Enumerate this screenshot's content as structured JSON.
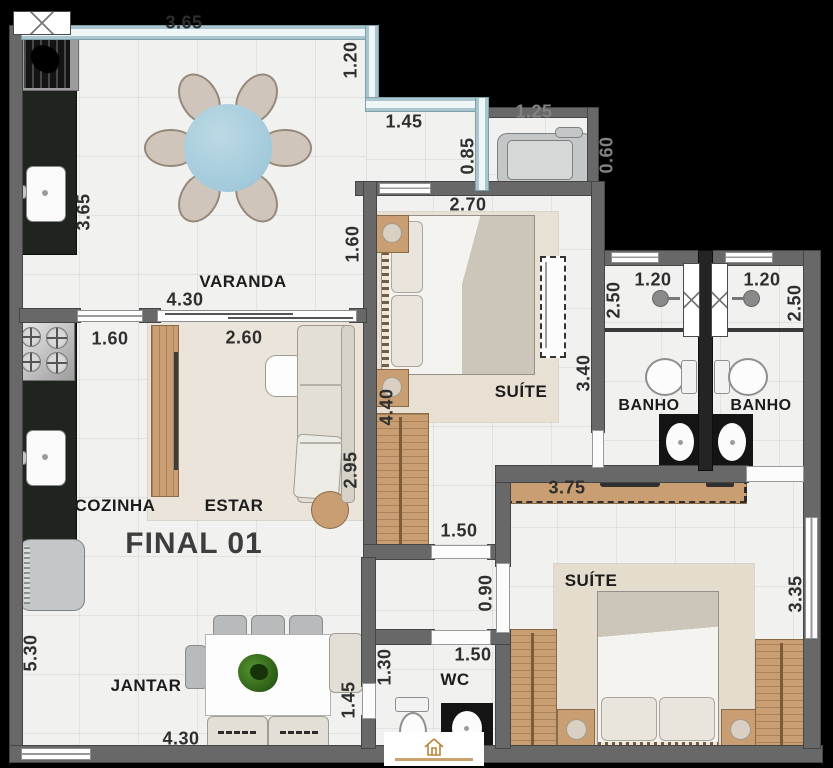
{
  "title": {
    "unit": "FINAL 01"
  },
  "rooms": {
    "varanda": "VARANDA",
    "cozinha": "COZINHA",
    "estar": "ESTAR",
    "jantar": "JANTAR",
    "suite1": "SUÍTE",
    "suite2": "SUÍTE",
    "banho1": "BANHO",
    "banho2": "BANHO",
    "wc": "WC"
  },
  "dims": {
    "varanda_top": "3.65",
    "varanda_left": "3.65",
    "varanda_right": "1.20",
    "step_w": "1.45",
    "step_h": "0.85",
    "ac_w": "1.25",
    "ac_h": "0.60",
    "suite1_w": "2.70",
    "varanda_door": "1.60",
    "estar_door": "4.30",
    "cozinha_w": "1.60",
    "estar_w": "2.60",
    "suite1_h": "4.40",
    "estar_h": "2.95",
    "closet1": "3.40",
    "banho1_h": "2.50",
    "banho1_w": "1.20",
    "banho2_w": "1.20",
    "banho2_h": "2.50",
    "desk": "3.75",
    "hall_door": "1.50",
    "hall_w": "0.90",
    "wc_w": "1.50",
    "wc_h": "1.30",
    "jantar_door": "1.45",
    "jantar_h": "5.30",
    "jantar_w": "4.30",
    "suite2_h": "3.35"
  },
  "colors": {
    "wall": "#686868",
    "glass": "#a9c6cf",
    "wood": "#c89e72",
    "counter": "#1f251e",
    "carpet": "#e8e0d2",
    "floor": "#f1f1ef",
    "background": "#000000",
    "logo_gold": "#b8863b"
  },
  "watermark": {
    "icon": "realtor-house-logo"
  }
}
